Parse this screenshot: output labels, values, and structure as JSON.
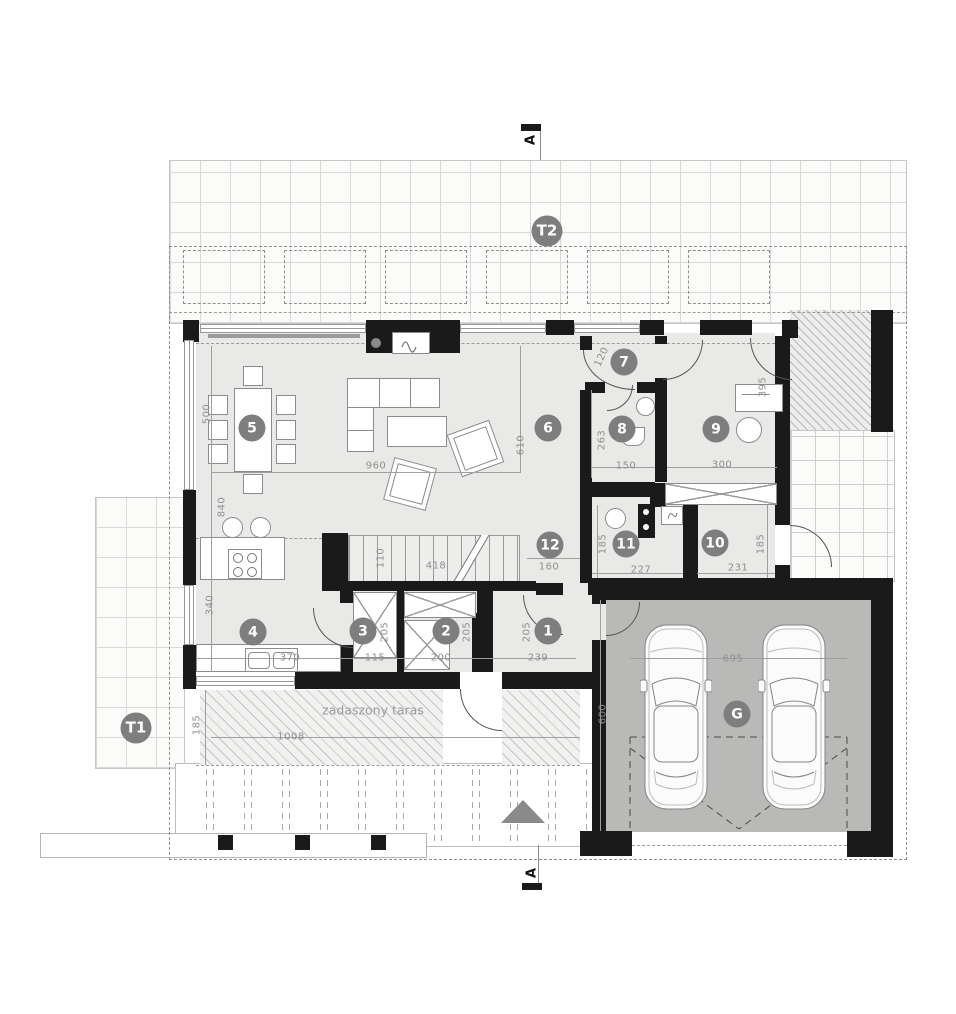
{
  "drawing": {
    "section_marker_label": "A",
    "covered_terrace_label": "zadaszony taras"
  },
  "colors": {
    "wall": "#1a1a1a",
    "room-fill": "#e9e9e7",
    "garage-fill": "#b9b9b8",
    "badge-bg": "#7e7e7e",
    "dim-color": "#8f8f8f"
  },
  "room_badges": [
    {
      "label": "1",
      "x": 548,
      "y": 631
    },
    {
      "label": "2",
      "x": 446,
      "y": 631
    },
    {
      "label": "3",
      "x": 363,
      "y": 631
    },
    {
      "label": "4",
      "x": 253,
      "y": 632
    },
    {
      "label": "5",
      "x": 252,
      "y": 428
    },
    {
      "label": "6",
      "x": 548,
      "y": 428
    },
    {
      "label": "7",
      "x": 624,
      "y": 362
    },
    {
      "label": "8",
      "x": 622,
      "y": 429
    },
    {
      "label": "9",
      "x": 716,
      "y": 429
    },
    {
      "label": "10",
      "x": 715,
      "y": 543
    },
    {
      "label": "11",
      "x": 626,
      "y": 544
    },
    {
      "label": "12",
      "x": 550,
      "y": 545
    },
    {
      "label": "G",
      "x": 737,
      "y": 714
    }
  ],
  "terrace_badges": [
    {
      "label": "T1",
      "x": 136,
      "y": 728
    },
    {
      "label": "T2",
      "x": 547,
      "y": 231
    }
  ],
  "dimensions": [
    {
      "text": "500",
      "x": 207,
      "y": 414,
      "r": -90
    },
    {
      "text": "840",
      "x": 222,
      "y": 507,
      "r": -90
    },
    {
      "text": "340",
      "x": 210,
      "y": 605,
      "r": -90
    },
    {
      "text": "960",
      "x": 376,
      "y": 466,
      "r": 0
    },
    {
      "text": "610",
      "x": 521,
      "y": 445,
      "r": -90
    },
    {
      "text": "418",
      "x": 436,
      "y": 566,
      "r": 0
    },
    {
      "text": "110",
      "x": 381,
      "y": 558,
      "r": -90
    },
    {
      "text": "160",
      "x": 549,
      "y": 567,
      "r": 0
    },
    {
      "text": "370",
      "x": 290,
      "y": 658,
      "r": 0
    },
    {
      "text": "115",
      "x": 375,
      "y": 658,
      "r": 0
    },
    {
      "text": "200",
      "x": 441,
      "y": 658,
      "r": 0
    },
    {
      "text": "239",
      "x": 538,
      "y": 658,
      "r": 0
    },
    {
      "text": "205",
      "x": 385,
      "y": 632,
      "r": -90
    },
    {
      "text": "205",
      "x": 467,
      "y": 632,
      "r": -90
    },
    {
      "text": "205",
      "x": 527,
      "y": 632,
      "r": -90
    },
    {
      "text": "120",
      "x": 602,
      "y": 357,
      "r": -65
    },
    {
      "text": "263",
      "x": 602,
      "y": 440,
      "r": -90
    },
    {
      "text": "150",
      "x": 626,
      "y": 466,
      "r": 0
    },
    {
      "text": "300",
      "x": 722,
      "y": 465,
      "r": 0
    },
    {
      "text": "395",
      "x": 763,
      "y": 387,
      "r": -90
    },
    {
      "text": "185",
      "x": 603,
      "y": 544,
      "r": -90
    },
    {
      "text": "227",
      "x": 641,
      "y": 570,
      "r": 0
    },
    {
      "text": "231",
      "x": 738,
      "y": 568,
      "r": 0
    },
    {
      "text": "185",
      "x": 761,
      "y": 544,
      "r": -90
    },
    {
      "text": "695",
      "x": 733,
      "y": 659,
      "r": 0
    },
    {
      "text": "600",
      "x": 603,
      "y": 714,
      "r": -90
    },
    {
      "text": "1008",
      "x": 291,
      "y": 737,
      "r": 0
    },
    {
      "text": "185",
      "x": 197,
      "y": 725,
      "r": -90
    }
  ]
}
